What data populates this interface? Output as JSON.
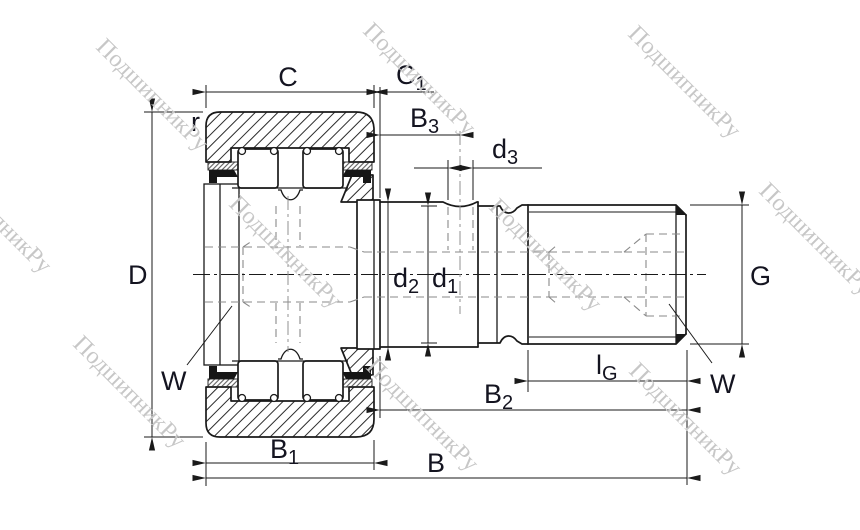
{
  "labels": {
    "C": {
      "main": "C",
      "sub": ""
    },
    "C1": {
      "main": "C",
      "sub": "1"
    },
    "B3": {
      "main": "B",
      "sub": "3"
    },
    "d3": {
      "main": "d",
      "sub": "3"
    },
    "r": {
      "main": "r",
      "sub": ""
    },
    "D": {
      "main": "D",
      "sub": ""
    },
    "d2": {
      "main": "d",
      "sub": "2"
    },
    "d1": {
      "main": "d",
      "sub": "1"
    },
    "G": {
      "main": "G",
      "sub": ""
    },
    "W_left": {
      "main": "W",
      "sub": ""
    },
    "W_right": {
      "main": "W",
      "sub": ""
    },
    "lG": {
      "main": "l",
      "sub": "G"
    },
    "B2": {
      "main": "B",
      "sub": "2"
    },
    "B1": {
      "main": "B",
      "sub": "1"
    },
    "B": {
      "main": "B",
      "sub": ""
    }
  },
  "watermark": {
    "text": "ПодшипникРу"
  },
  "colors": {
    "line": "#1a1a1a",
    "label": "#141420",
    "watermark": "#c7c7c7",
    "background": "#ffffff"
  }
}
